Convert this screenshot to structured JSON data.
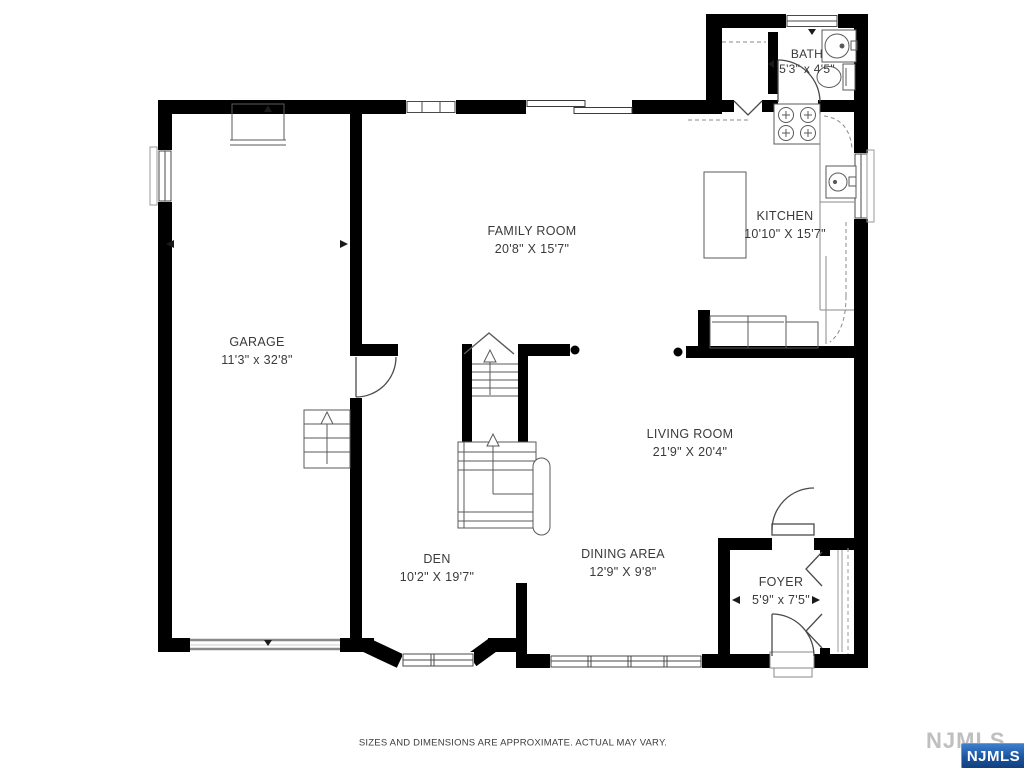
{
  "floorplan": {
    "rooms": [
      {
        "name": "FAMILY ROOM",
        "dims": "20'8\" X 15'7\""
      },
      {
        "name": "KITCHEN",
        "dims": "10'10\" X 15'7\""
      },
      {
        "name": "BATH",
        "dims": "5'3\" x 4'5\""
      },
      {
        "name": "GARAGE",
        "dims": "11'3\" x 32'8\""
      },
      {
        "name": "LIVING ROOM",
        "dims": "21'9\" X 20'4\""
      },
      {
        "name": "DEN",
        "dims": "10'2\" X 19'7\""
      },
      {
        "name": "DINING AREA",
        "dims": "12'9\" X 9'8\""
      },
      {
        "name": "FOYER",
        "dims": "5'9\" x 7'5\""
      }
    ],
    "disclaimer": "SIZES AND DIMENSIONS ARE APPROXIMATE. ACTUAL MAY VARY.",
    "watermark": {
      "background_text": "NJMLS",
      "badge_text": "NJMLS",
      "badge_color": "#1e5dad",
      "gray_color": "#bfbfbf"
    },
    "colors": {
      "walls": "#000000",
      "fixtures": "#4a4a4a",
      "background": "#ffffff"
    }
  }
}
